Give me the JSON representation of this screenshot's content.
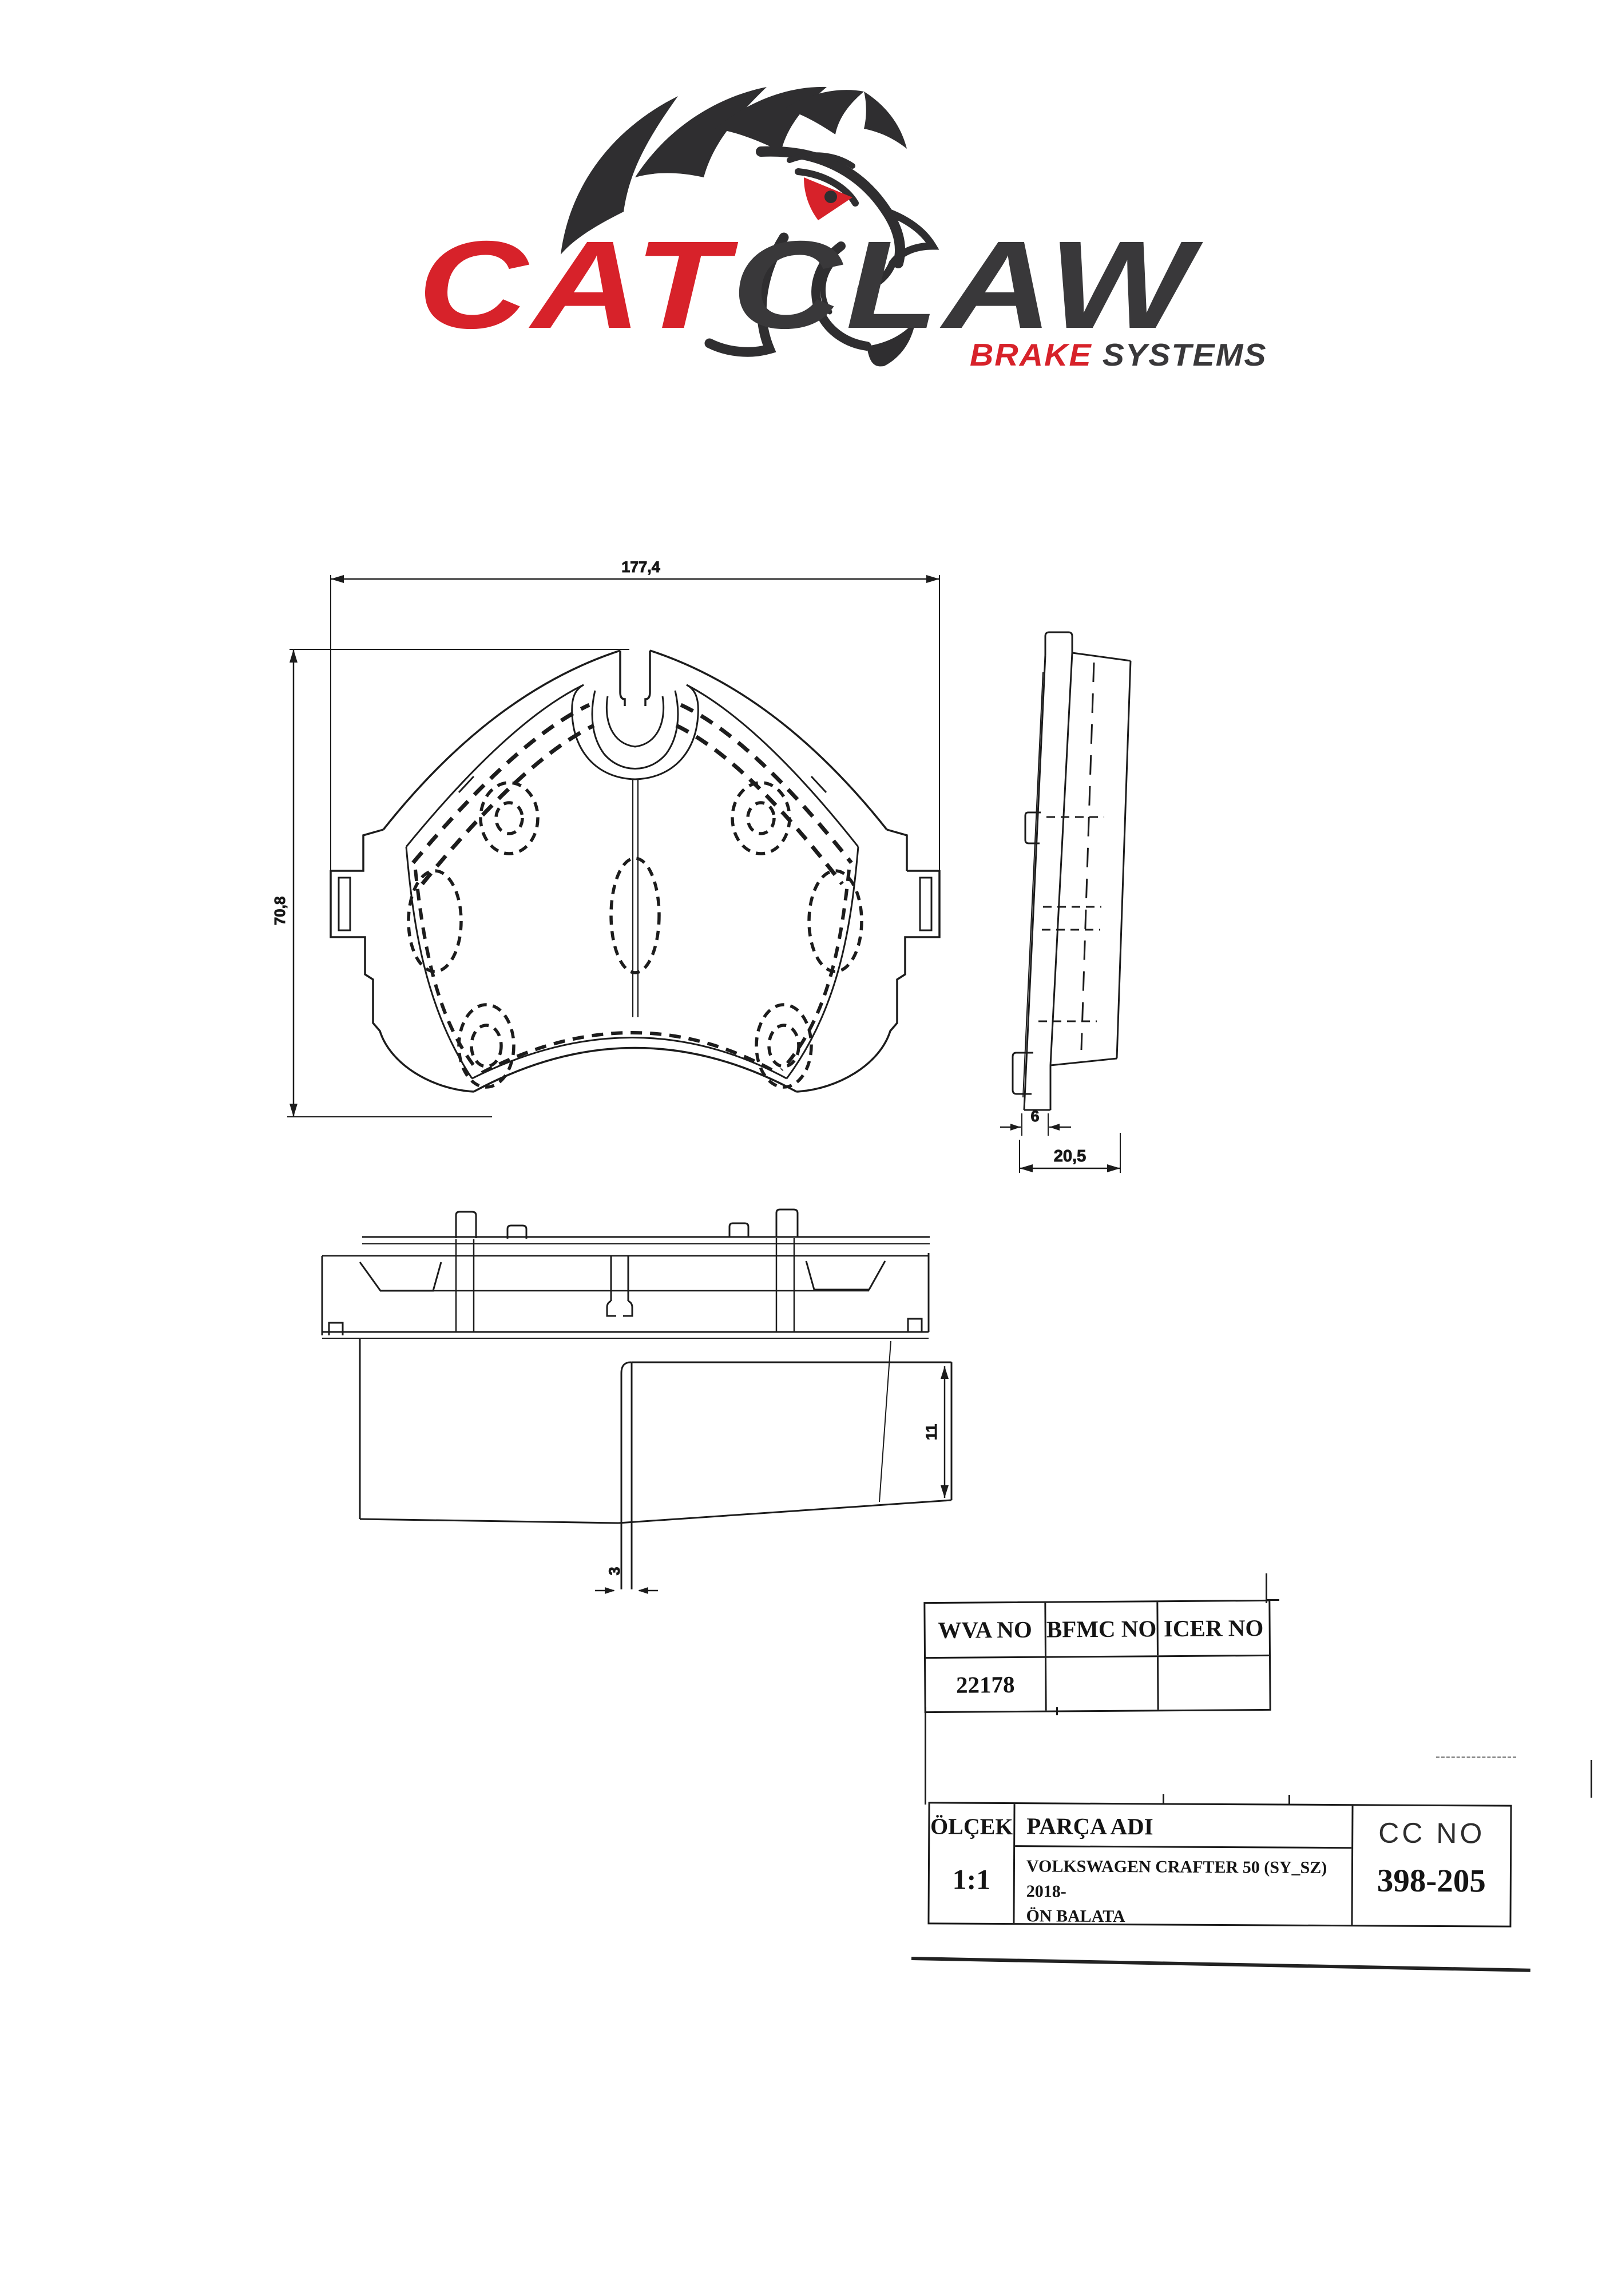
{
  "logo": {
    "brand_primary": "CAT",
    "brand_secondary": "CLAW",
    "tagline_primary": "BRAKE",
    "tagline_secondary": "SYSTEMS",
    "color_red": "#d7222a",
    "color_dark": "#39383a"
  },
  "views": {
    "front": {
      "width_dim": "177,4",
      "height_dim": "70,8"
    },
    "side": {
      "backplate_thickness_dim": "6",
      "total_thickness_dim": "20,5"
    },
    "plan": {
      "friction_height_dim": "11",
      "slot_width_dim": "3"
    }
  },
  "reference_table": {
    "headers": [
      "WVA NO",
      "BFMC NO",
      "ICER NO"
    ],
    "row": [
      "22178",
      "",
      ""
    ]
  },
  "title_block": {
    "scale_label": "ÖLÇEK",
    "scale_value": "1:1",
    "part_label": "PARÇA ADI",
    "part_name_line1": "VOLKSWAGEN CRAFTER 50 (SY_SZ) 2018-",
    "part_name_line2": "ÖN BALATA",
    "cc_label": "CC NO",
    "cc_value": "398-205"
  }
}
